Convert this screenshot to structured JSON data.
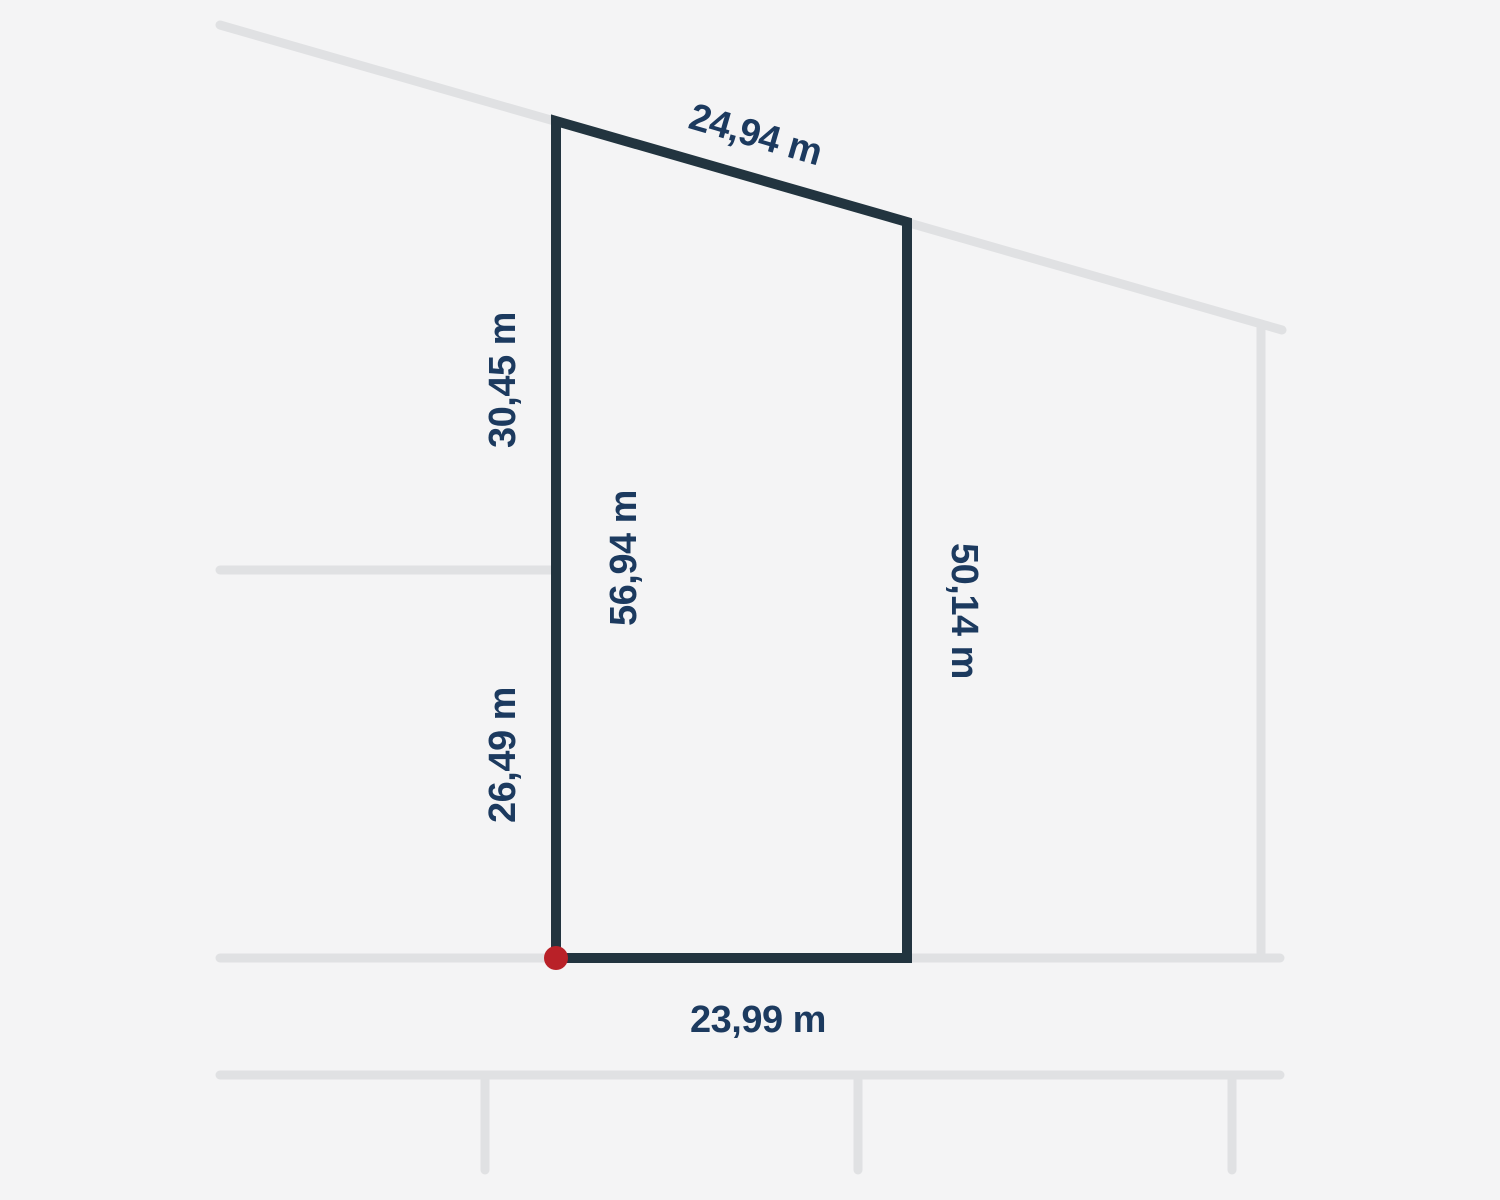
{
  "diagram": {
    "type": "land-plot-survey-diagram",
    "colors": {
      "background": "#f4f4f5",
      "context_line": "#e0e1e3",
      "outline": "#22343f",
      "label": "#1c3a5f",
      "marker": "#b92128"
    },
    "measurements": {
      "top": "24,94 m",
      "left_upper": "30,45 m",
      "left_total": "56,94 m",
      "left_lower": "26,49 m",
      "right": "50,14 m",
      "bottom": "23,99 m"
    },
    "marker": {
      "name": "corner-point",
      "position": "bottom-left-corner"
    }
  }
}
